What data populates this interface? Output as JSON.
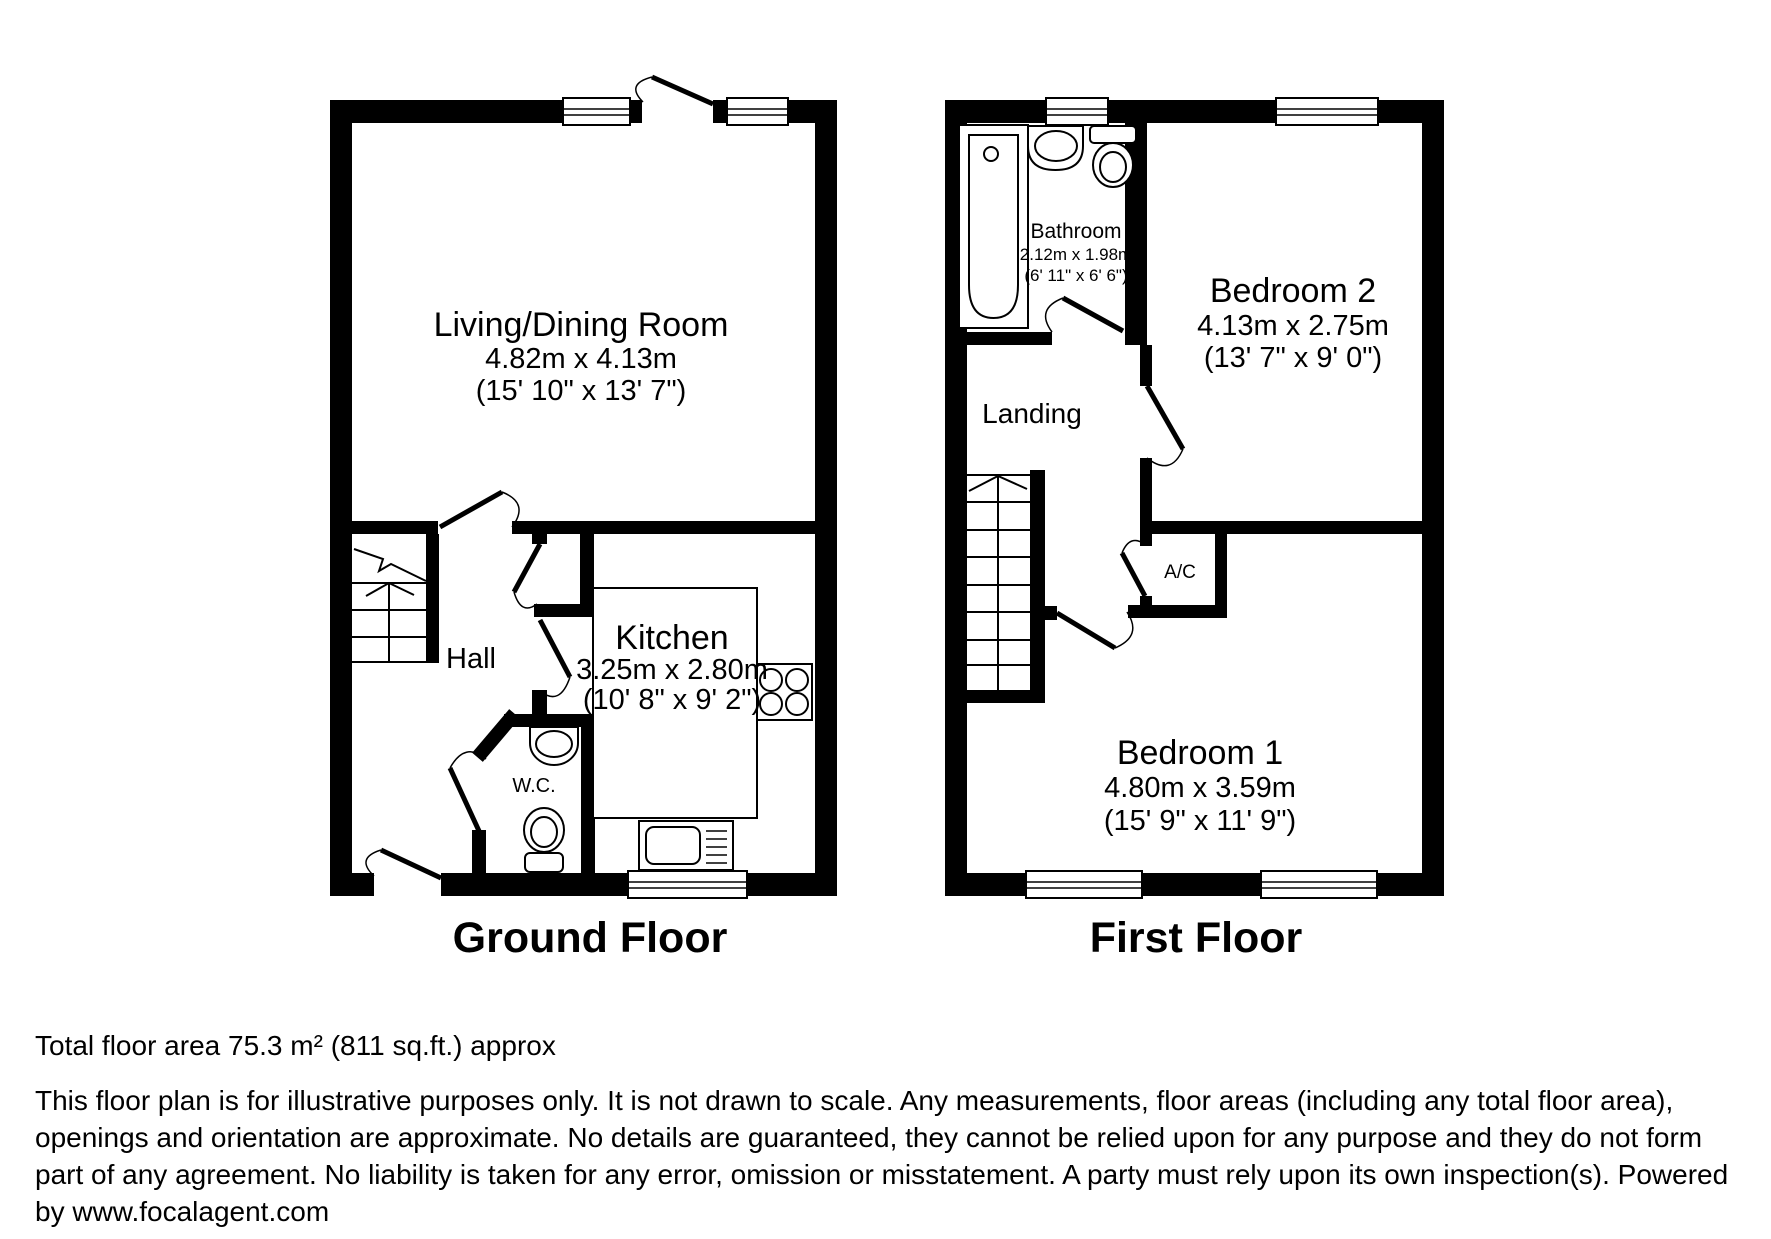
{
  "ground_floor": {
    "title": "Ground Floor",
    "rooms": {
      "living": {
        "name": "Living/Dining Room",
        "dim_m": "4.82m x 4.13m",
        "dim_ft": "(15' 10\" x 13' 7\")"
      },
      "kitchen": {
        "name": "Kitchen",
        "dim_m": "3.25m x 2.80m",
        "dim_ft": "(10' 8\" x 9' 2\")"
      },
      "hall": {
        "name": "Hall"
      },
      "wc": {
        "name": "W.C."
      }
    }
  },
  "first_floor": {
    "title": "First Floor",
    "rooms": {
      "bathroom": {
        "name": "Bathroom",
        "dim_m": "2.12m x 1.98m",
        "dim_ft": "(6' 11\" x 6' 6\")"
      },
      "bedroom2": {
        "name": "Bedroom 2",
        "dim_m": "4.13m x 2.75m",
        "dim_ft": "(13' 7\" x 9' 0\")"
      },
      "bedroom1": {
        "name": "Bedroom 1",
        "dim_m": "4.80m x 3.59m",
        "dim_ft": "(15' 9\" x 11' 9\")"
      },
      "landing": {
        "name": "Landing"
      },
      "ac": {
        "name": "A/C"
      }
    }
  },
  "footer": {
    "total_area": "Total floor area 75.3 m² (811 sq.ft.) approx",
    "disclaimer_lines": [
      "This floor plan is for illustrative purposes only. It is not drawn to scale. Any measurements, floor areas (including any total floor area),",
      "openings and orientation are approximate. No details are guaranteed, they cannot be relied upon for any purpose and they do not form",
      "part of any agreement. No liability is taken for any error, omission or misstatement. A party must rely upon its own inspection(s). Powered",
      "by www.focalagent.com"
    ]
  },
  "colors": {
    "wall": "#000000",
    "background": "#ffffff"
  }
}
